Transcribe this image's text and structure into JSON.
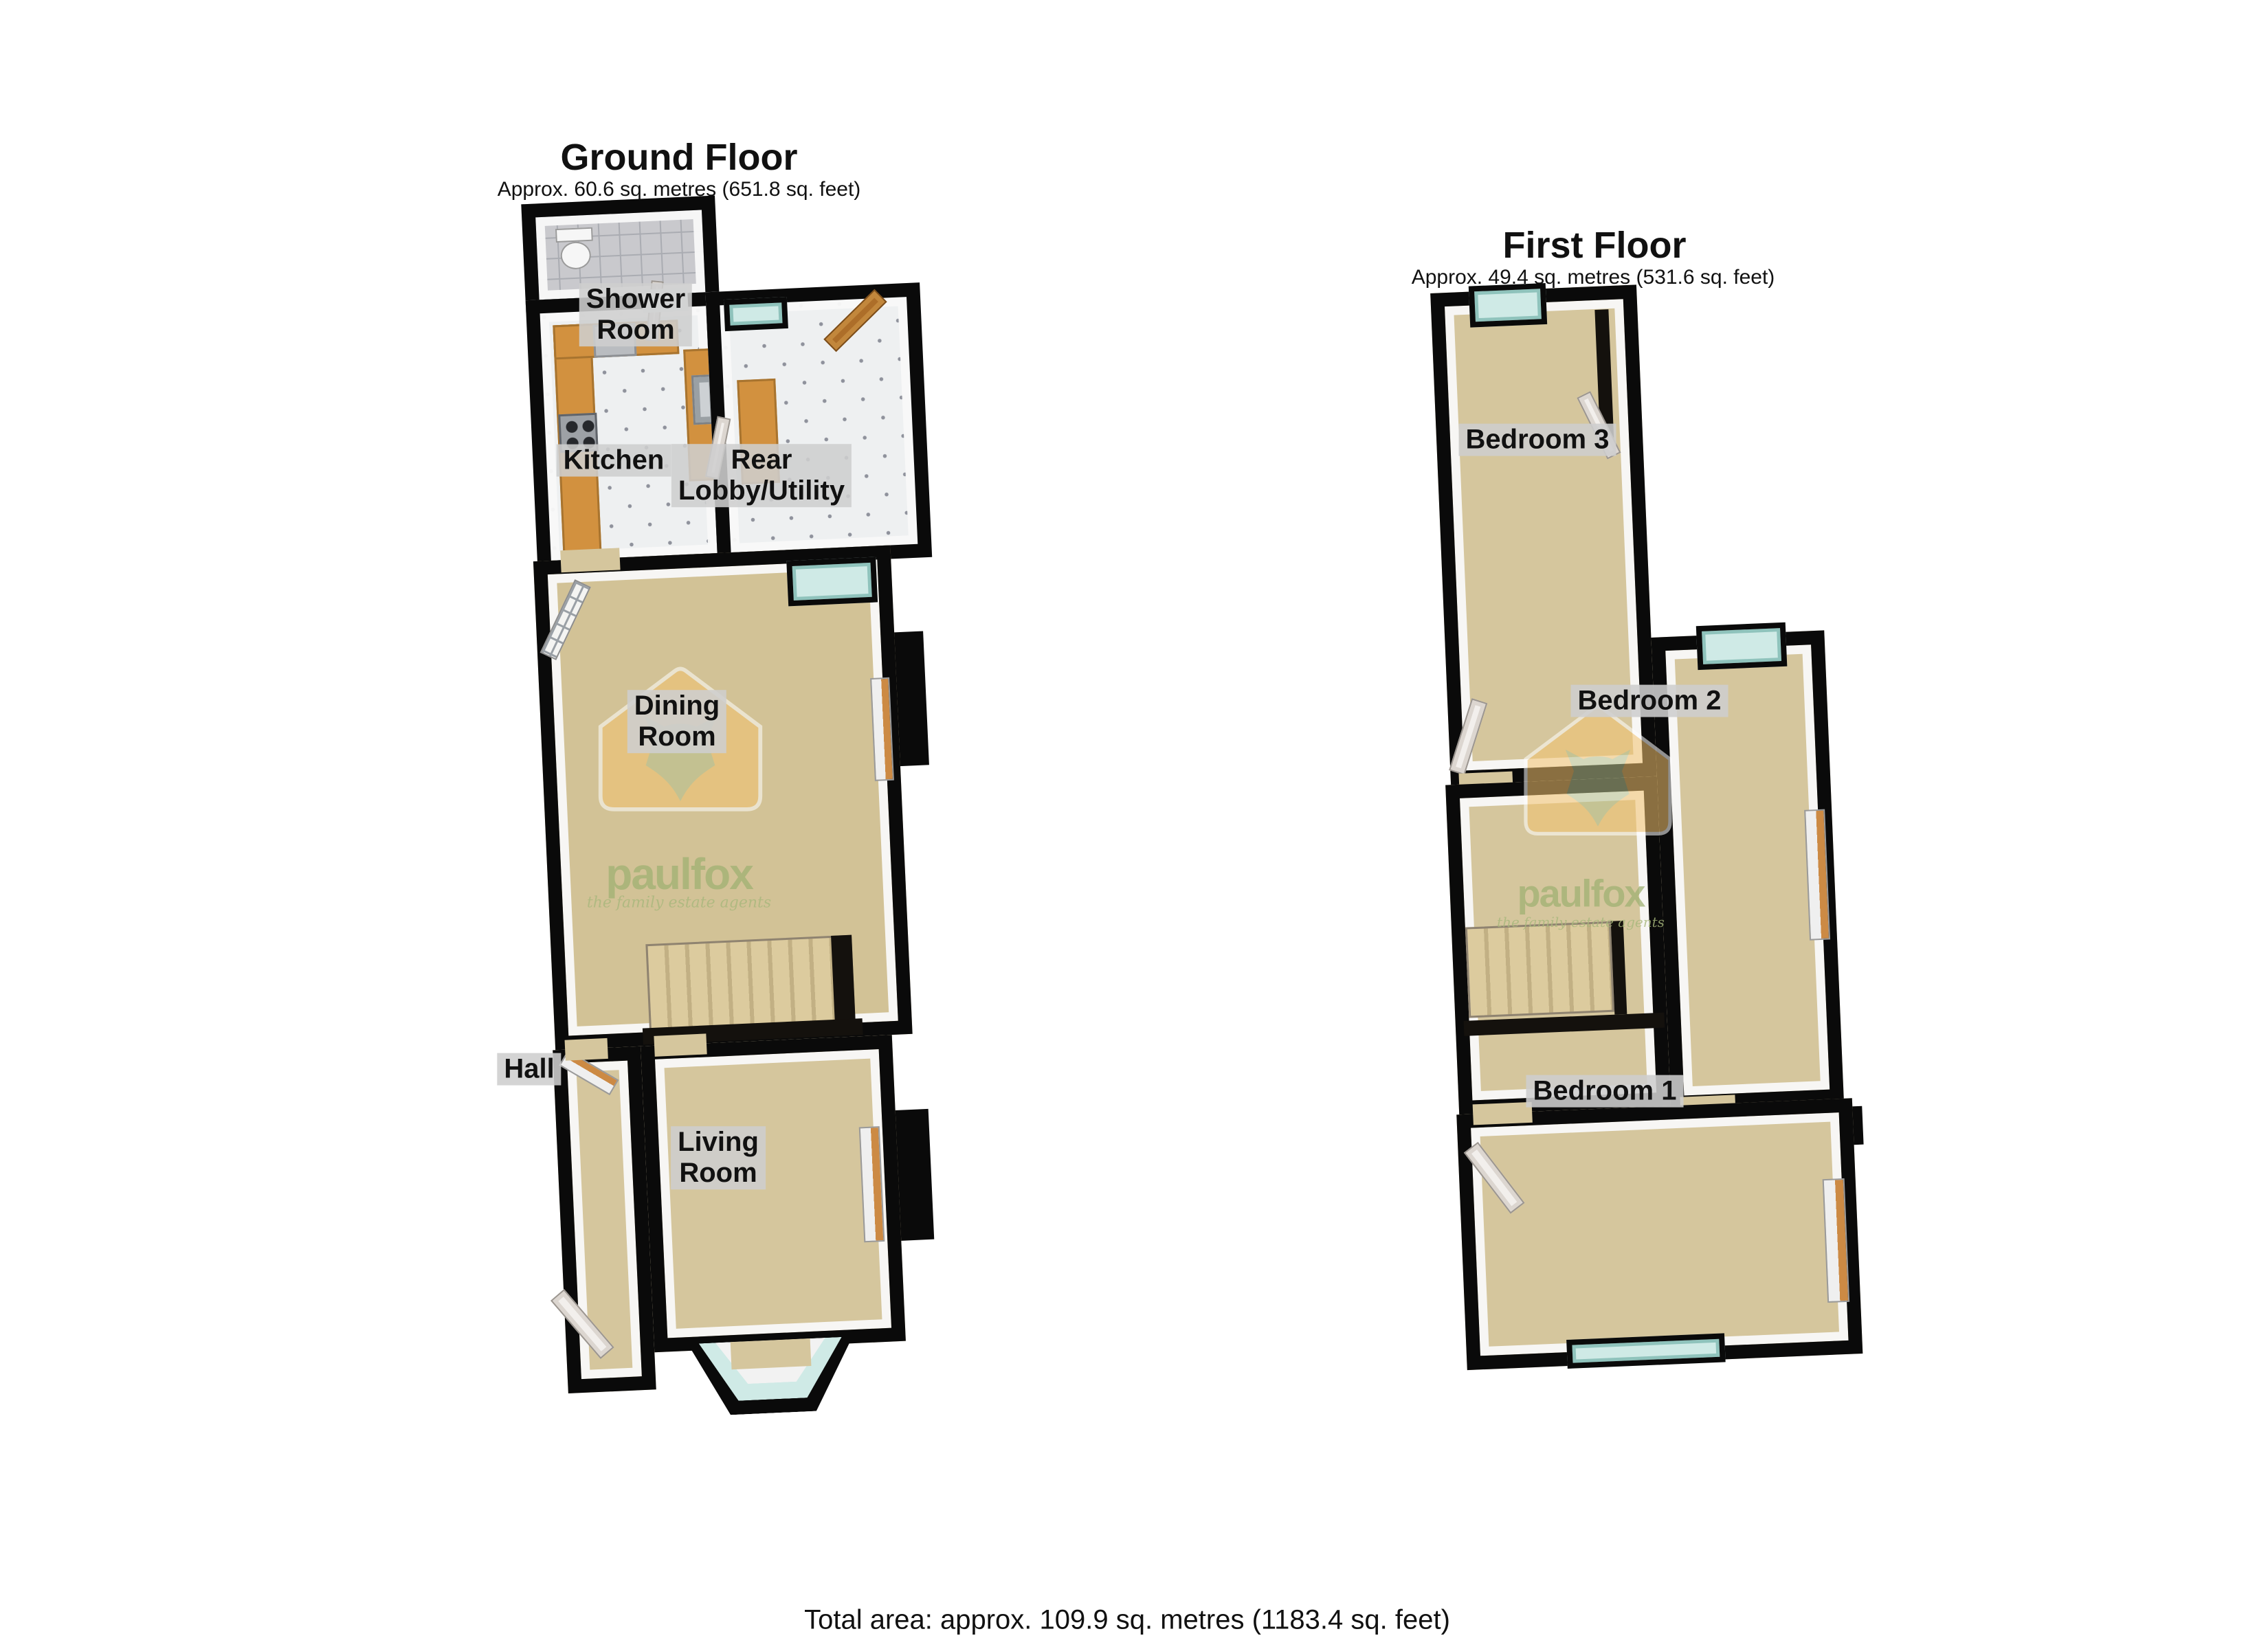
{
  "colors": {
    "wall": "#0a0a0a",
    "carpet": "#d5c69d",
    "kitchen_tile": "#eef0f1",
    "shower_tile": "#c9c9cd",
    "window_glass": "#cfeae6",
    "counter": "#d2913f",
    "radiator_accent": "#cc8a44",
    "wood_door": "#ad6e29",
    "label_background": "#cecece",
    "watermark_house": "#f3c36f",
    "watermark_fox": "#b7c18d",
    "watermark_text": "#a0b173"
  },
  "ground": {
    "title": "Ground Floor",
    "subtitle": "Approx. 60.6 sq. metres (651.8 sq. feet)",
    "rooms": {
      "shower": "Shower\nRoom",
      "kitchen": "Kitchen",
      "rear_lobby": "Rear\nLobby/Utility",
      "dining": "Dining\nRoom",
      "hall": "Hall",
      "living": "Living\nRoom"
    }
  },
  "first": {
    "title": "First Floor",
    "subtitle": "Approx. 49.4 sq. metres (531.6 sq. feet)",
    "rooms": {
      "bedroom3": "Bedroom 3",
      "bedroom2": "Bedroom 2",
      "bedroom1": "Bedroom 1"
    }
  },
  "watermark": {
    "brand": "paulfox",
    "tagline": "the family estate agents"
  },
  "footer": {
    "total_area": "Total area: approx. 109.9 sq. metres (1183.4 sq. feet)"
  }
}
